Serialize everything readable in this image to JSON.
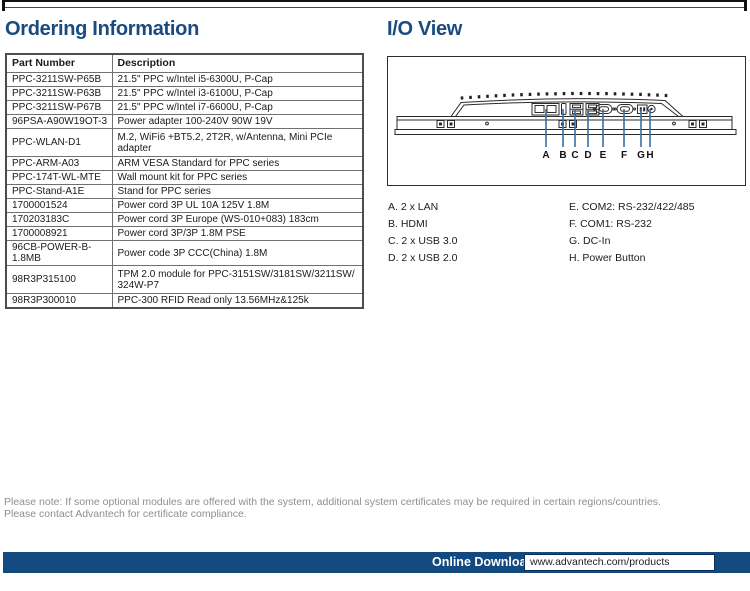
{
  "colors": {
    "heading-navy": "#1A4B80",
    "bar-navy": "#12497E",
    "leader-blue": "#3A6EA5",
    "note-gray": "#8D8F91",
    "line-dark": "#2B2B2B",
    "table-border": "#6E7073"
  },
  "headings": {
    "ordering": "Ordering Information",
    "io_view": "I/O View"
  },
  "ordering_table": {
    "columns": [
      "Part Number",
      "Description"
    ],
    "rows": [
      {
        "part": "PPC-3211SW-P65B",
        "desc": "21.5\" PPC w/Intel i5-6300U, P-Cap"
      },
      {
        "part": "PPC-3211SW-P63B",
        "desc": "21.5\" PPC w/Intel i3-6100U, P-Cap"
      },
      {
        "part": "PPC-3211SW-P67B",
        "desc": "21.5\" PPC w/Intel i7-6600U, P-Cap"
      },
      {
        "part": "96PSA-A90W19OT-3",
        "desc": "Power adapter 100-240V 90W 19V"
      },
      {
        "part": "PPC-WLAN-D1",
        "desc": "M.2, WiFi6 +BT5.2, 2T2R, w/Antenna, Mini PCIe\nadapter"
      },
      {
        "part": "PPC-ARM-A03",
        "desc": "ARM VESA Standard for PPC series"
      },
      {
        "part": "PPC-174T-WL-MTE",
        "desc": "Wall mount kit for PPC series"
      },
      {
        "part": "PPC-Stand-A1E",
        "desc": "Stand for PPC series"
      },
      {
        "part": "1700001524",
        "desc": "Power cord 3P UL 10A 125V 1.8M"
      },
      {
        "part": "170203183C",
        "desc": "Power cord 3P Europe (WS-010+083) 183cm"
      },
      {
        "part": "1700008921",
        "desc": "Power cord 3P/3P 1.8M PSE"
      },
      {
        "part": "96CB-POWER-B-1.8MB",
        "desc": "Power code 3P CCC(China) 1.8M"
      },
      {
        "part": "98R3P315100",
        "desc": "TPM 2.0 module for PPC-3151SW/3181SW/3211SW/\n324W-P7"
      },
      {
        "part": "98R3P300010",
        "desc": "PPC-300 RFID Read only 13.56MHz&125k"
      }
    ]
  },
  "io_view": {
    "port_letters": [
      "A",
      "B",
      "C",
      "D",
      "E",
      "F",
      "G",
      "H"
    ],
    "legend_left": [
      "A. 2 x LAN",
      "B. HDMI",
      "C. 2 x USB 3.0",
      "D. 2 x USB 2.0"
    ],
    "legend_right": [
      "E. COM2: RS-232/422/485",
      "F. COM1: RS-232",
      "G. DC-In",
      "H. Power Button"
    ]
  },
  "footer": {
    "note_lines": [
      "Please note: If some optional modules are offered with the system, additional system certificates may be required in certain regions/countries.",
      "Please contact Advantech for certificate compliance."
    ],
    "download_label": "Online Download",
    "download_url": "www.advantech.com/products"
  }
}
